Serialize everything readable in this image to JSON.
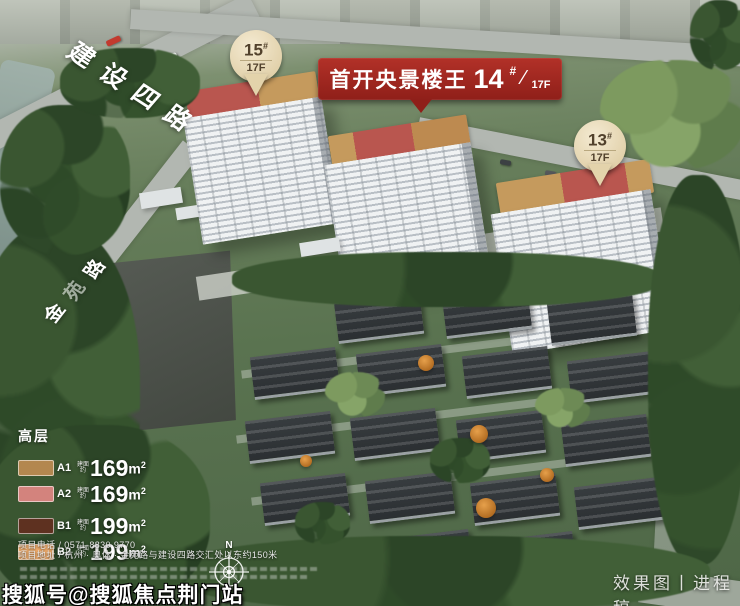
{
  "roads": {
    "top": "建设四路",
    "left": "金苑路"
  },
  "banner": {
    "title": "首开央景楼王",
    "number": "14",
    "hash": "#",
    "slash": "⁄",
    "floors": "17F",
    "bg_color": "#a5231c"
  },
  "pins": {
    "p15": {
      "number": "15",
      "hash": "#",
      "floors": "17F"
    },
    "p13": {
      "number": "13",
      "hash": "#",
      "floors": "17F"
    }
  },
  "legend": {
    "title": "高层",
    "prefix_top": "建面",
    "prefix_bottom": "约",
    "unit_base": "m",
    "unit_sup": "2",
    "items": [
      {
        "code": "A1",
        "area": "169",
        "color": "#b3874f"
      },
      {
        "code": "A2",
        "area": "169",
        "color": "#d3837d"
      },
      {
        "code": "B1",
        "area": "199",
        "color": "#5e3120"
      },
      {
        "code": "B2",
        "area": "199",
        "color": "#f0ad6d"
      }
    ]
  },
  "contact": {
    "phone": "项目电话 / 0571-8830 9770",
    "address": "项目地址 / 杭州 · 奥体 · 金苑路与建设四路交汇处以东约150米"
  },
  "compass": {
    "north": "N"
  },
  "footer": {
    "caption": "效果图丨进程稿",
    "watermark": "搜狐号@搜狐焦点荆门站"
  },
  "colors": {
    "roof_red": "#b9564f",
    "roof_tan": "#c59a5d",
    "pin_cream": "#ecdfc2"
  }
}
